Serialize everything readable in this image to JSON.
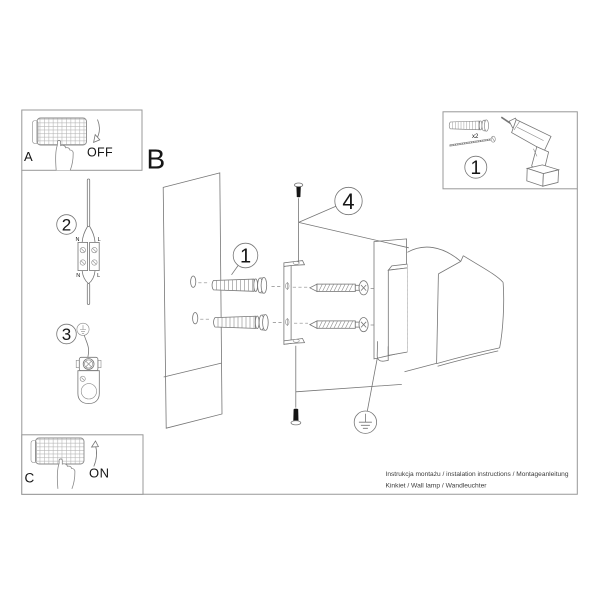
{
  "colors": {
    "background": "#ffffff",
    "line_art": "#767676",
    "panel_border": "#989898",
    "text": "#161616",
    "screw_fill": "#151515"
  },
  "panel_a": {
    "label": "A",
    "state": "OFF"
  },
  "panel_c": {
    "label": "C",
    "state": "ON"
  },
  "section_b": {
    "label": "B"
  },
  "callouts": {
    "tools": "1",
    "wall_plug": "1",
    "wiring": "2",
    "grounding": "3",
    "fixing": "4"
  },
  "tools_panel": {
    "plug_quantity": "x2"
  },
  "wiring": {
    "top_n": "N",
    "top_l": "L",
    "bottom_n": "N",
    "bottom_l": "L"
  },
  "footer": {
    "line1": "Instrukcja montażu / instalation instructions / Montageanleitung",
    "line2": "Kinkiet / Wall lamp / Wandleuchter"
  }
}
